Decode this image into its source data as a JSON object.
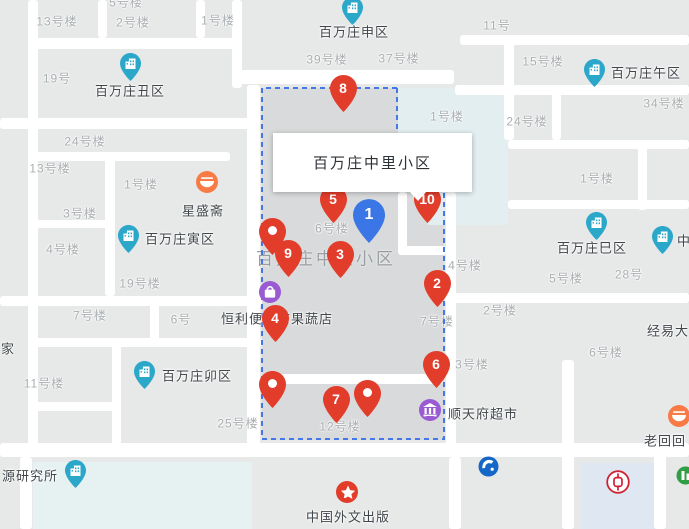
{
  "info_card": {
    "title": "百万庄中里小区"
  },
  "watermark": {
    "text": "百万庄中里小区",
    "x": 326,
    "y": 257
  },
  "colors": {
    "pin_red": "#e23c2b",
    "pin_blue": "#3b76e6",
    "area_marker_teal": "#2ba7c9",
    "poi_orange": "#f87a45",
    "poi_purple": "#9a5ad2",
    "selection_dash_blue": "#4677e8",
    "water_area": "#e2eef0",
    "bank_of_china_red": "#cf2233",
    "construction_bank_blue": "#1467c6"
  },
  "building_labels": [
    {
      "text": "5号楼",
      "x": 126,
      "y": 2
    },
    {
      "text": "13号楼",
      "x": 57,
      "y": 21
    },
    {
      "text": "2号楼",
      "x": 133,
      "y": 22
    },
    {
      "text": "1号楼",
      "x": 218,
      "y": 20
    },
    {
      "text": "19号",
      "x": 57,
      "y": 78
    },
    {
      "text": "39号楼",
      "x": 327,
      "y": 59
    },
    {
      "text": "37号楼",
      "x": 399,
      "y": 58
    },
    {
      "text": "11号",
      "x": 497,
      "y": 25
    },
    {
      "text": "15号楼",
      "x": 543,
      "y": 61
    },
    {
      "text": "34号楼",
      "x": 664,
      "y": 103
    },
    {
      "text": "24号楼",
      "x": 527,
      "y": 121
    },
    {
      "text": "24号楼",
      "x": 85,
      "y": 141
    },
    {
      "text": "13号楼",
      "x": 50,
      "y": 168
    },
    {
      "text": "1号楼",
      "x": 141,
      "y": 184
    },
    {
      "text": "3号楼",
      "x": 80,
      "y": 213
    },
    {
      "text": "4号楼",
      "x": 63,
      "y": 249
    },
    {
      "text": "1号楼",
      "x": 447,
      "y": 116
    },
    {
      "text": "1号楼",
      "x": 597,
      "y": 178
    },
    {
      "text": "6号楼",
      "x": 332,
      "y": 228
    },
    {
      "text": "4号楼",
      "x": 465,
      "y": 265
    },
    {
      "text": "5号楼",
      "x": 566,
      "y": 278
    },
    {
      "text": "28号",
      "x": 629,
      "y": 274
    },
    {
      "text": "19号楼",
      "x": 140,
      "y": 283
    },
    {
      "text": "7号楼",
      "x": 90,
      "y": 315
    },
    {
      "text": "6号",
      "x": 181,
      "y": 319
    },
    {
      "text": "7号楼",
      "x": 437,
      "y": 321
    },
    {
      "text": "2号楼",
      "x": 500,
      "y": 310
    },
    {
      "text": "3号楼",
      "x": 472,
      "y": 364
    },
    {
      "text": "6号楼",
      "x": 606,
      "y": 352
    },
    {
      "text": "11号楼",
      "x": 44,
      "y": 383
    },
    {
      "text": "25号楼",
      "x": 238,
      "y": 423
    },
    {
      "text": "12号楼",
      "x": 340,
      "y": 426
    }
  ],
  "dark_labels": [
    {
      "text": "经易大",
      "x": 668,
      "y": 330
    },
    {
      "text": "家",
      "x": 8,
      "y": 348
    },
    {
      "text": "老回回",
      "x": 665,
      "y": 440
    }
  ],
  "area_sites": [
    {
      "name": "百万庄丑区",
      "marker_x": 130,
      "marker_y": 64,
      "label_x": 130,
      "label_y": 90
    },
    {
      "name": "百万庄申区",
      "marker_x": 352,
      "marker_y": 8,
      "label_x": 354,
      "label_y": 31
    },
    {
      "name": "百万庄午区",
      "marker_x": 594,
      "marker_y": 70,
      "label_x": 646,
      "label_y": 72
    },
    {
      "name": "百万庄寅区",
      "marker_x": 128,
      "marker_y": 236,
      "label_x": 180,
      "label_y": 238
    },
    {
      "name": "百万庄卯区",
      "marker_x": 144,
      "marker_y": 372,
      "label_x": 197,
      "label_y": 375
    },
    {
      "name": "百万庄巳区",
      "marker_x": 596,
      "marker_y": 223,
      "label_x": 592,
      "label_y": 247
    },
    {
      "name": "源研究所",
      "marker_x": 75,
      "marker_y": 471,
      "label_x": 30,
      "label_y": 475
    },
    {
      "name": "中",
      "marker_x": 662,
      "marker_y": 237,
      "label_x": 684,
      "label_y": 240
    }
  ],
  "pois": [
    {
      "name": "星盛斋",
      "icon": "food-icon",
      "marker_x": 207,
      "marker_y": 182,
      "label_x": 203,
      "label_y": 210
    },
    {
      "name": "恒利便利店果蔬店",
      "icon": "bag-icon",
      "marker_x": 270,
      "marker_y": 292,
      "label_x": 277,
      "label_y": 318
    },
    {
      "name": "顺天府超市",
      "icon": "bank-columns-icon",
      "marker_x": 430,
      "marker_y": 410,
      "label_x": 483,
      "label_y": 413
    },
    {
      "name": "中国外文出版",
      "icon": "star-icon",
      "marker_x": 347,
      "marker_y": 492,
      "label_x": 348,
      "label_y": 516
    }
  ],
  "numbered_pins": [
    {
      "label": "8",
      "color": "red",
      "x": 343,
      "y": 88
    },
    {
      "label": "5",
      "color": "red",
      "x": 333,
      "y": 199
    },
    {
      "label": "10",
      "color": "red",
      "x": 427,
      "y": 199
    },
    {
      "label": "1",
      "color": "blue",
      "x": 369,
      "y": 215
    },
    {
      "label": "9",
      "color": "red",
      "x": 288,
      "y": 253
    },
    {
      "label": "3",
      "color": "red",
      "x": 340,
      "y": 254
    },
    {
      "label": "2",
      "color": "red",
      "x": 437,
      "y": 283
    },
    {
      "label": "4",
      "color": "red",
      "x": 275,
      "y": 318
    },
    {
      "label": "6",
      "color": "red",
      "x": 436,
      "y": 364
    },
    {
      "label": "7",
      "color": "red",
      "x": 336,
      "y": 399
    }
  ],
  "dot_pins": [
    {
      "x": 272,
      "y": 231
    },
    {
      "x": 272,
      "y": 384
    },
    {
      "x": 367,
      "y": 393
    }
  ],
  "logos": [
    {
      "name": "restaurant-logo-marker",
      "x": 679,
      "y": 416
    },
    {
      "name": "construction-bank-logo",
      "x": 489,
      "y": 467
    },
    {
      "name": "bank-of-china-logo",
      "x": 617,
      "y": 481
    },
    {
      "name": "green-poi-logo",
      "x": 687,
      "y": 477
    }
  ]
}
